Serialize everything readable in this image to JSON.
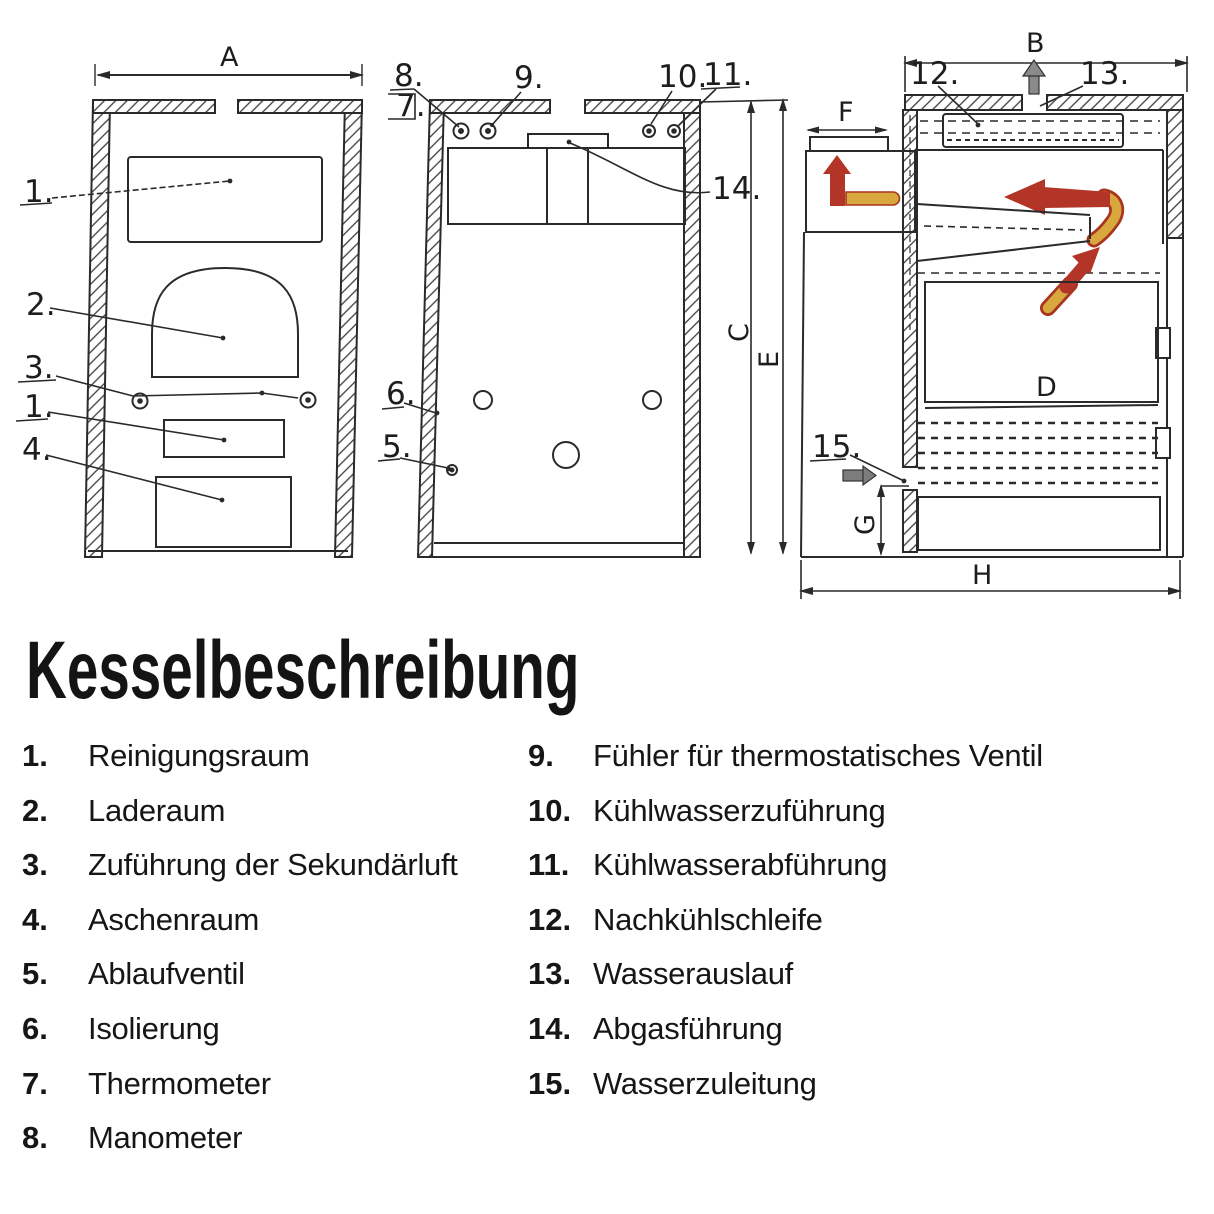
{
  "title": "Kesselbeschreibung",
  "legend_left": [
    {
      "num": "1.",
      "label": "Reinigungsraum"
    },
    {
      "num": "2.",
      "label": "Laderaum"
    },
    {
      "num": "3.",
      "label": "Zuführung der Sekundärluft"
    },
    {
      "num": "4.",
      "label": "Aschenraum"
    },
    {
      "num": "5.",
      "label": "Ablaufventil"
    },
    {
      "num": "6.",
      "label": "Isolierung"
    },
    {
      "num": "7.",
      "label": "Thermometer"
    },
    {
      "num": "8.",
      "label": "Manometer"
    }
  ],
  "legend_right": [
    {
      "num": "9.",
      "label": "Fühler für thermostatisches Ventil"
    },
    {
      "num": "10.",
      "label": "Kühlwasserzuführung"
    },
    {
      "num": "11.",
      "label": "Kühlwasserabführung"
    },
    {
      "num": "12.",
      "label": "Nachkühlschleife"
    },
    {
      "num": "13.",
      "label": "Wasserauslauf"
    },
    {
      "num": "14.",
      "label": "Abgasführung"
    },
    {
      "num": "15.",
      "label": "Wasserzuleitung"
    }
  ],
  "diagram": {
    "dimension_labels": {
      "a": "A",
      "b": "B",
      "c": "C",
      "d": "D",
      "e": "E",
      "f": "F",
      "g": "G",
      "h": "H"
    },
    "callouts": {
      "n1": "1.",
      "n1b": "1.",
      "n2": "2.",
      "n3": "3.",
      "n4": "4.",
      "n5": "5.",
      "n6": "6.",
      "n7": "7.",
      "n8": "8.",
      "n9": "9.",
      "n10": "10.",
      "n11": "11.",
      "n12": "12.",
      "n13": "13.",
      "n14": "14.",
      "n15": "15."
    },
    "colors": {
      "ink": "#2a2a2a",
      "flue_hot": "#b23527",
      "pipe_yellow": "#d8a83e",
      "water_grey": "#8a8a8a"
    }
  }
}
